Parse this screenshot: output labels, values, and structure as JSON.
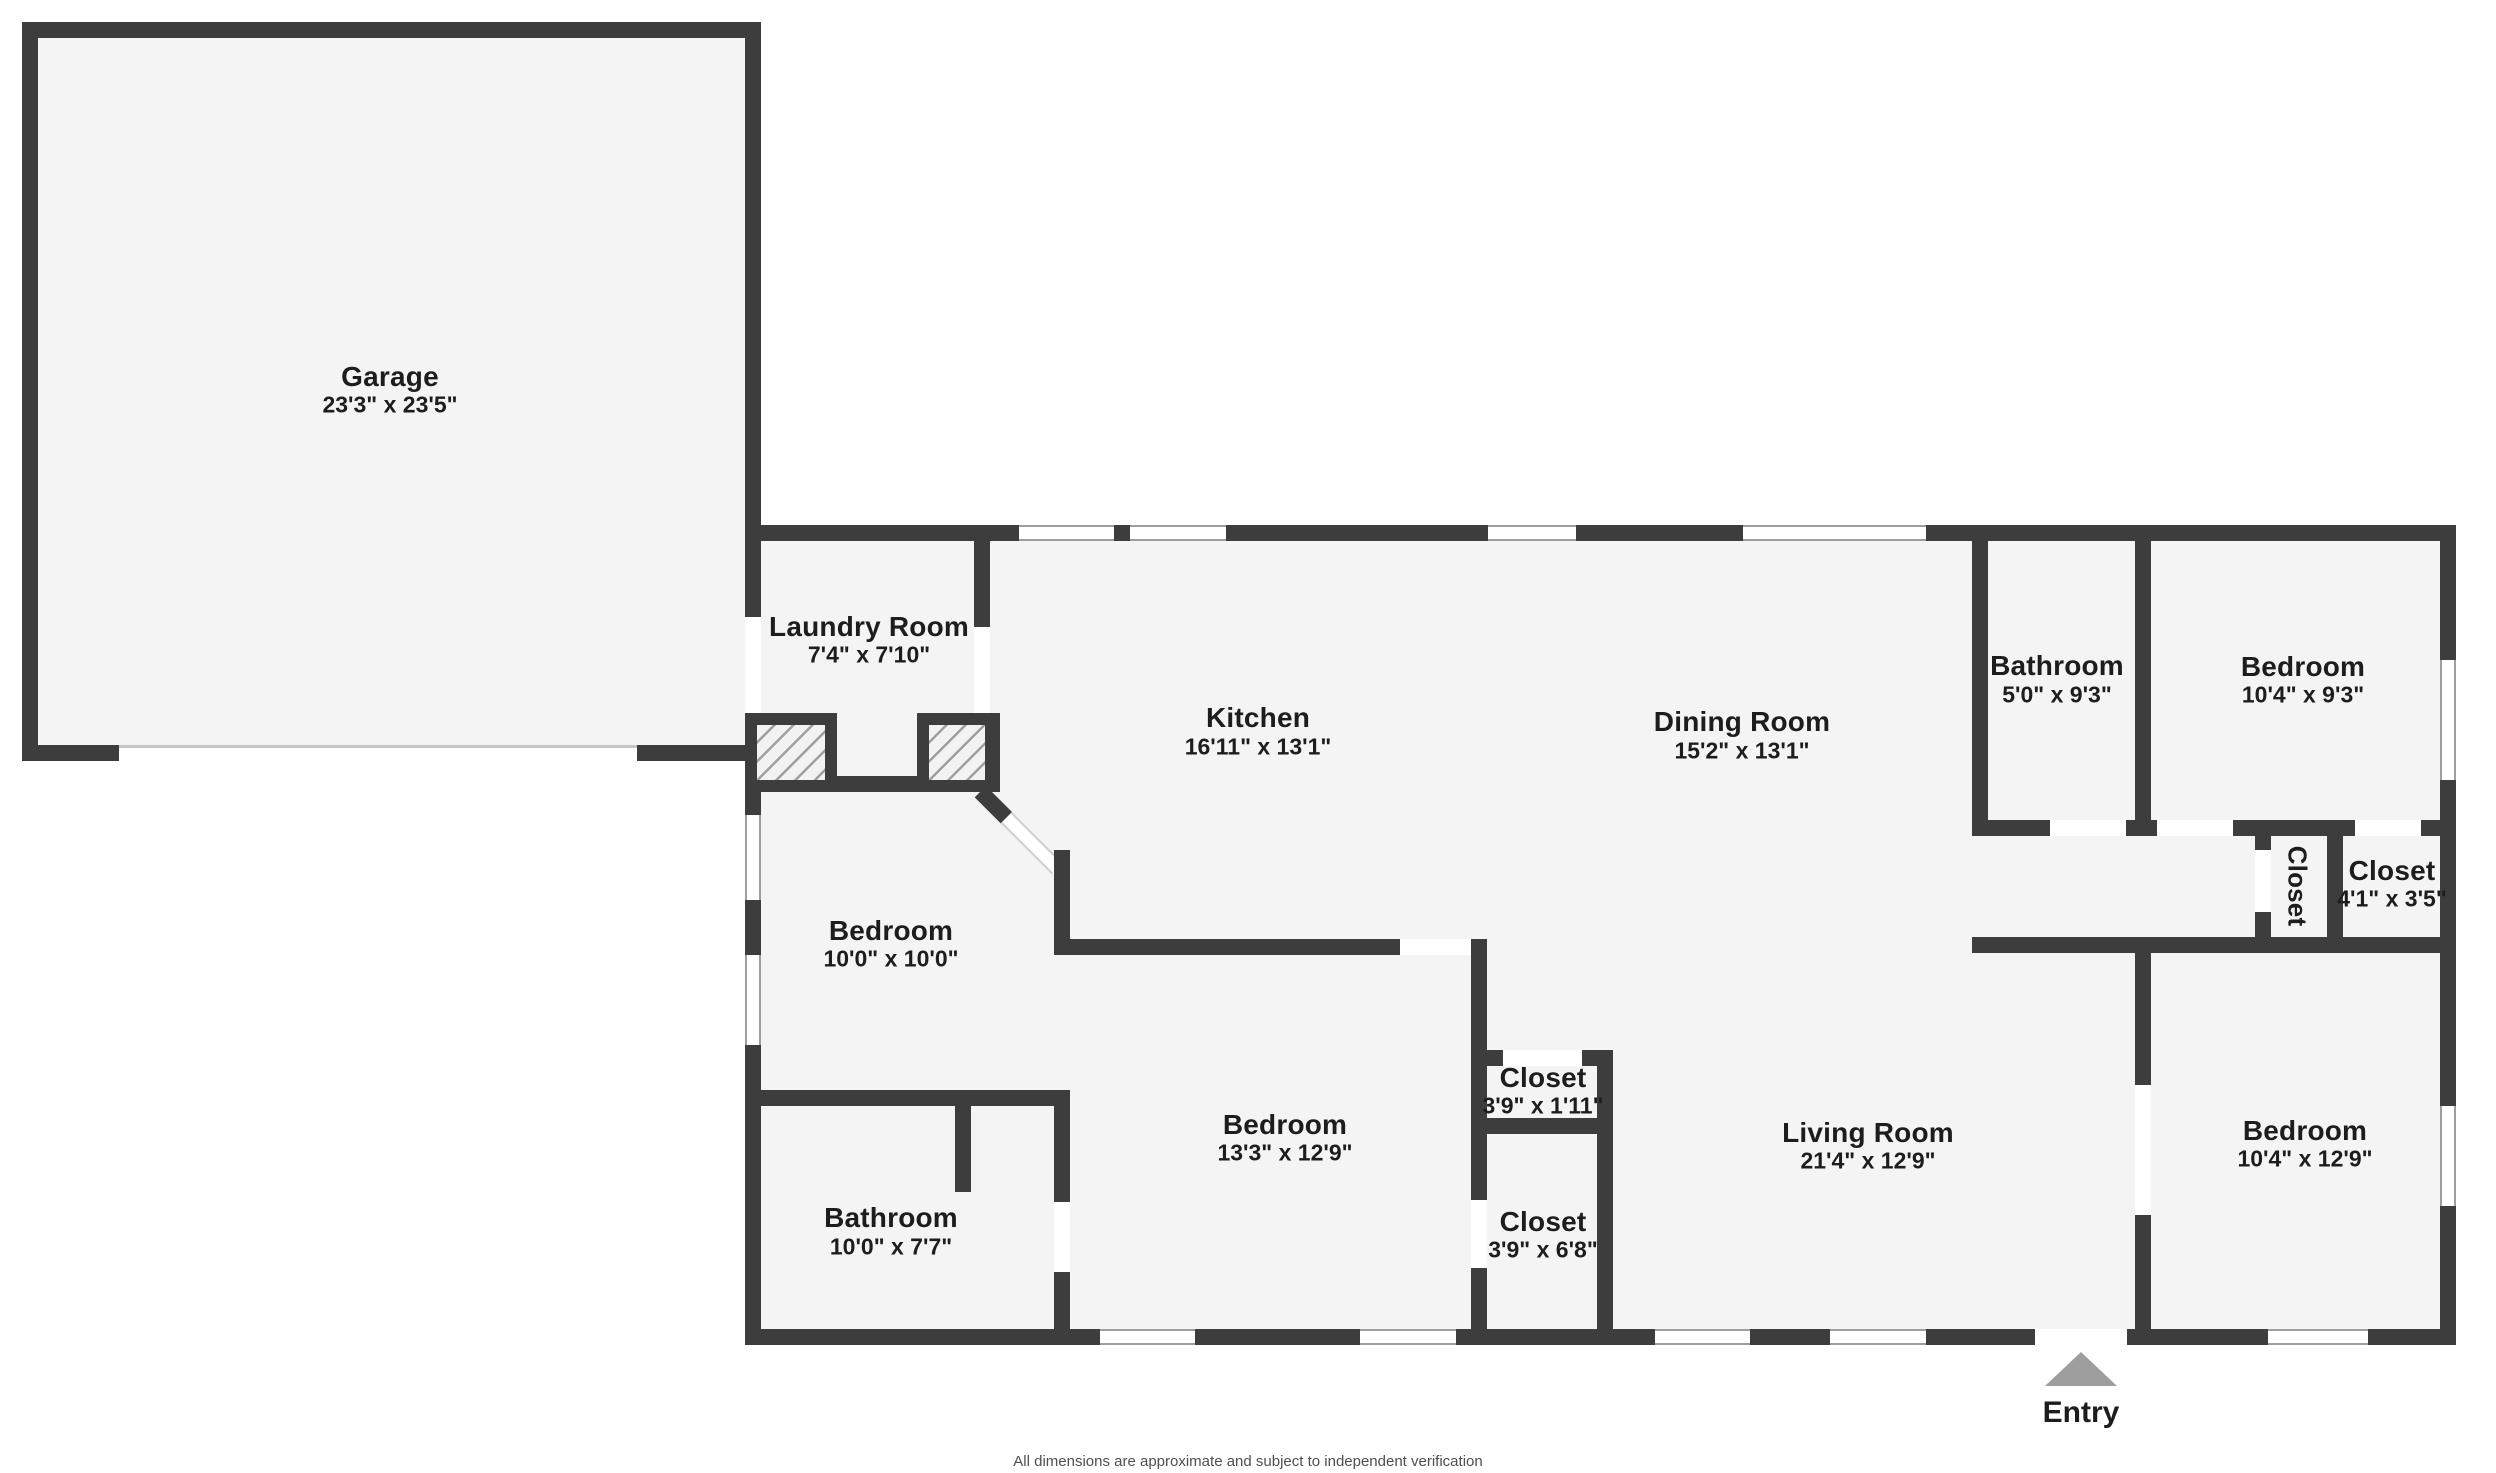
{
  "plan": {
    "rooms": [
      {
        "id": "garage",
        "name": "Garage",
        "dims": "23'3\" x 23'5\""
      },
      {
        "id": "laundry",
        "name": "Laundry Room",
        "dims": "7'4\" x 7'10\""
      },
      {
        "id": "kitchen",
        "name": "Kitchen",
        "dims": "16'11\" x 13'1\""
      },
      {
        "id": "dining",
        "name": "Dining Room",
        "dims": "15'2\" x 13'1\""
      },
      {
        "id": "bathroom-top",
        "name": "Bathroom",
        "dims": "5'0\" x 9'3\""
      },
      {
        "id": "bedroom-top-right",
        "name": "Bedroom",
        "dims": "10'4\" x 9'3\""
      },
      {
        "id": "closet-hall",
        "name": "Closet",
        "dims": ""
      },
      {
        "id": "closet-right",
        "name": "Closet",
        "dims": "4'1\" x 3'5\""
      },
      {
        "id": "bedroom-left",
        "name": "Bedroom",
        "dims": "10'0\" x 10'0\""
      },
      {
        "id": "bathroom-left",
        "name": "Bathroom",
        "dims": "10'0\" x 7'7\""
      },
      {
        "id": "bedroom-middle",
        "name": "Bedroom",
        "dims": "13'3\" x 12'9\""
      },
      {
        "id": "closet-small",
        "name": "Closet",
        "dims": "3'9\" x 1'11\""
      },
      {
        "id": "closet-tall",
        "name": "Closet",
        "dims": "3'9\" x 6'8\""
      },
      {
        "id": "living-room",
        "name": "Living Room",
        "dims": "21'4\" x 12'9\""
      },
      {
        "id": "bedroom-bottom-right",
        "name": "Bedroom",
        "dims": "10'4\" x 12'9\""
      }
    ],
    "entry_label": "Entry",
    "disclaimer": "All dimensions are approximate and subject to independent verification",
    "colors": {
      "wall": "#3d3d3d",
      "room_fill": "#f4f4f4",
      "window_line": "#9e9e9e",
      "entry_arrow": "#9e9e9e",
      "text": "#1d1d1d"
    }
  }
}
